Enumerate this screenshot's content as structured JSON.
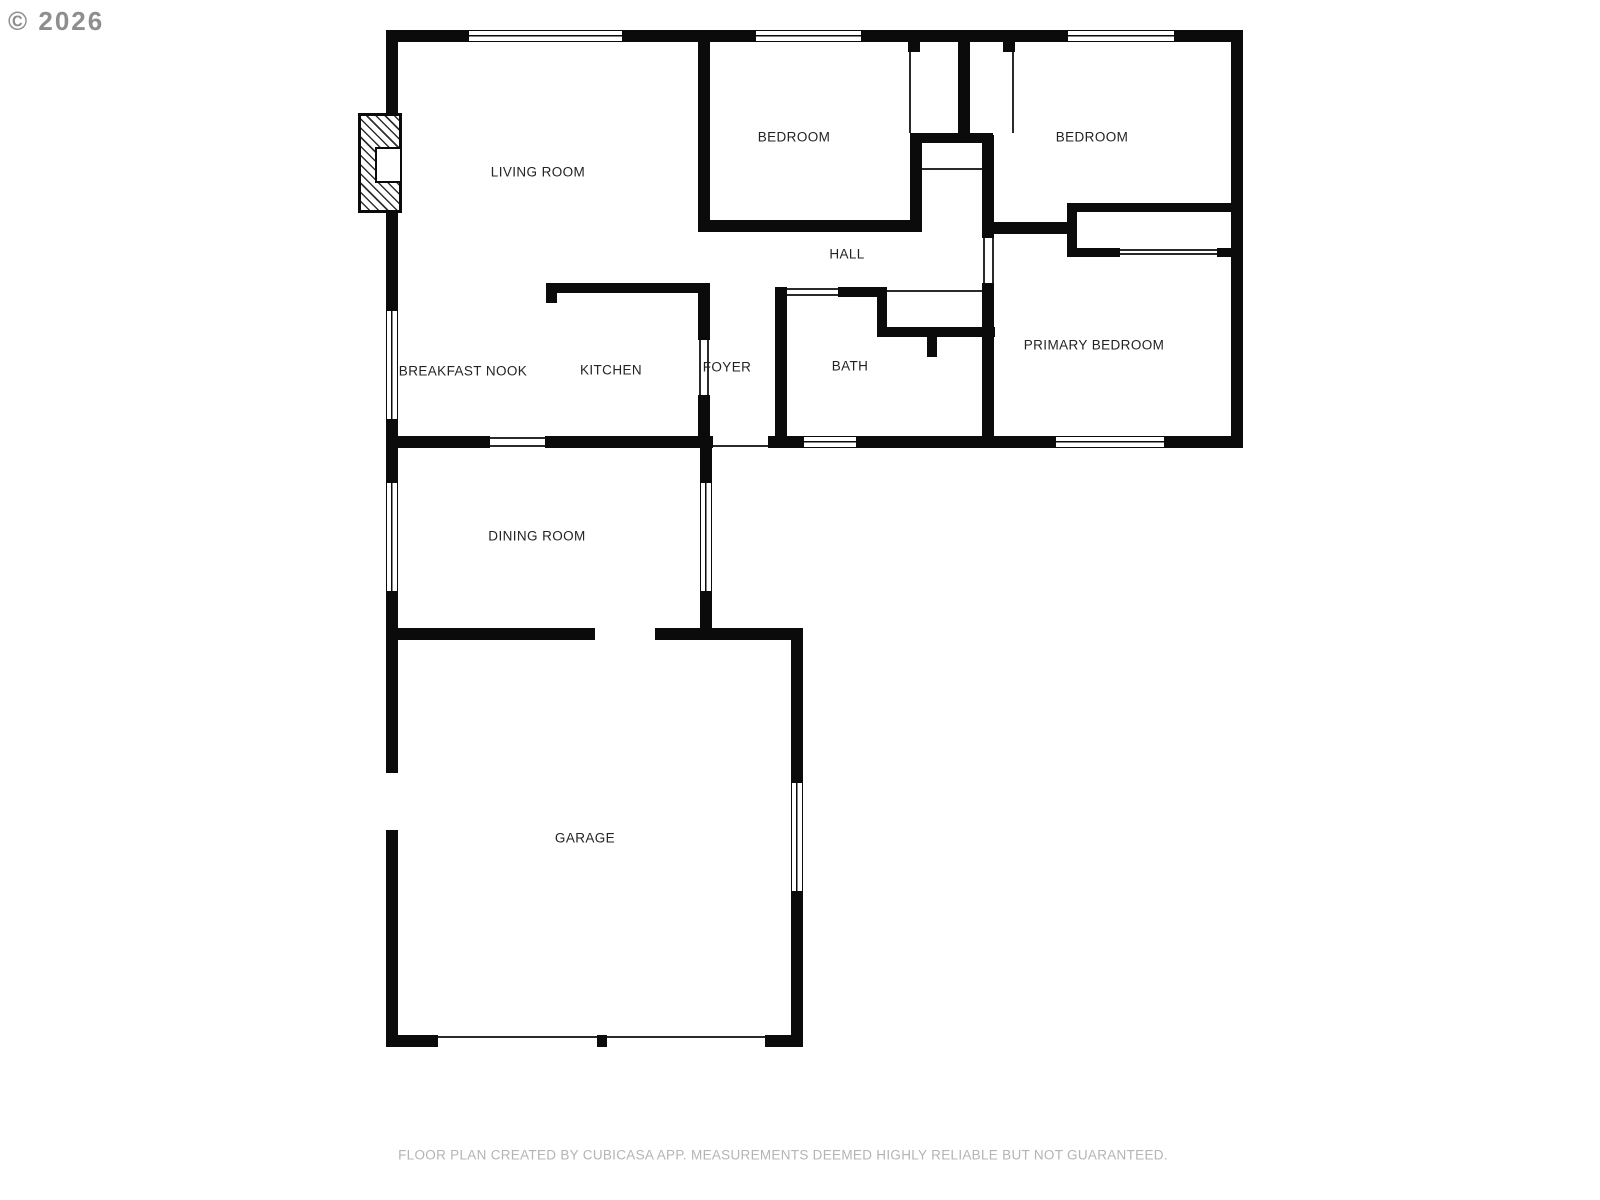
{
  "copyright": "© 2026",
  "footer": "FLOOR PLAN CREATED BY CUBICASA APP. MEASUREMENTS DEEMED HIGHLY RELIABLE BUT NOT GUARANTEED.",
  "colors": {
    "wall": "#0b0b0b",
    "label": "#232323",
    "footer_text": "#b4b4b4",
    "copyright": "#8e8e8e",
    "background": "#ffffff"
  },
  "rooms": [
    {
      "id": "living-room",
      "label": "LIVING ROOM",
      "x": 538,
      "y": 172
    },
    {
      "id": "bedroom-1",
      "label": "BEDROOM",
      "x": 794,
      "y": 137
    },
    {
      "id": "bedroom-2",
      "label": "BEDROOM",
      "x": 1092,
      "y": 137
    },
    {
      "id": "hall",
      "label": "HALL",
      "x": 847,
      "y": 254
    },
    {
      "id": "breakfast-nook",
      "label": "BREAKFAST NOOK",
      "x": 463,
      "y": 371
    },
    {
      "id": "kitchen",
      "label": "KITCHEN",
      "x": 611,
      "y": 370
    },
    {
      "id": "foyer",
      "label": "FOYER",
      "x": 727,
      "y": 367
    },
    {
      "id": "bath",
      "label": "BATH",
      "x": 850,
      "y": 366
    },
    {
      "id": "primary-bedroom",
      "label": "PRIMARY BEDROOM",
      "x": 1094,
      "y": 345
    },
    {
      "id": "dining-room",
      "label": "DINING ROOM",
      "x": 537,
      "y": 536
    },
    {
      "id": "garage",
      "label": "GARAGE",
      "x": 585,
      "y": 838
    }
  ],
  "plan": {
    "walls": [
      [
        386,
        30,
        82,
        12
      ],
      [
        623,
        30,
        132,
        12
      ],
      [
        862,
        30,
        205,
        12
      ],
      [
        1175,
        30,
        68,
        12
      ],
      [
        1231,
        30,
        12,
        418
      ],
      [
        386,
        436,
        104,
        12
      ],
      [
        545,
        436,
        168,
        12
      ],
      [
        768,
        436,
        35,
        12
      ],
      [
        857,
        436,
        198,
        12
      ],
      [
        1165,
        436,
        78,
        12
      ],
      [
        386,
        30,
        12,
        83
      ],
      [
        386,
        213,
        12,
        97
      ],
      [
        386,
        420,
        12,
        62
      ],
      [
        386,
        592,
        12,
        181
      ],
      [
        386,
        830,
        12,
        217
      ],
      [
        700,
        436,
        12,
        46
      ],
      [
        700,
        592,
        12,
        48
      ],
      [
        386,
        628,
        209,
        12
      ],
      [
        655,
        628,
        148,
        12
      ],
      [
        791,
        628,
        12,
        154
      ],
      [
        791,
        892,
        12,
        155
      ],
      [
        386,
        1035,
        52,
        12
      ],
      [
        597,
        1035,
        10,
        12
      ],
      [
        765,
        1035,
        38,
        12
      ],
      [
        698,
        30,
        12,
        192
      ],
      [
        698,
        220,
        220,
        12
      ],
      [
        910,
        133,
        12,
        99
      ],
      [
        908,
        42,
        12,
        10
      ],
      [
        958,
        42,
        12,
        100
      ],
      [
        1003,
        42,
        12,
        10
      ],
      [
        910,
        133,
        83,
        10
      ],
      [
        982,
        135,
        12,
        103
      ],
      [
        982,
        222,
        85,
        12
      ],
      [
        1067,
        203,
        176,
        9
      ],
      [
        1067,
        203,
        10,
        54
      ],
      [
        1067,
        248,
        53,
        9
      ],
      [
        1217,
        248,
        14,
        9
      ],
      [
        982,
        283,
        12,
        153
      ],
      [
        838,
        287,
        49,
        10
      ],
      [
        775,
        287,
        12,
        149
      ],
      [
        877,
        297,
        10,
        40
      ],
      [
        877,
        327,
        118,
        10
      ],
      [
        927,
        337,
        10,
        20
      ],
      [
        546,
        283,
        164,
        10
      ],
      [
        546,
        283,
        11,
        20
      ],
      [
        698,
        293,
        12,
        47
      ],
      [
        698,
        395,
        12,
        53
      ]
    ],
    "windows": [
      {
        "x": 468,
        "y": 30,
        "w": 155,
        "h": 12,
        "o": "h"
      },
      {
        "x": 755,
        "y": 30,
        "w": 107,
        "h": 12,
        "o": "h"
      },
      {
        "x": 1067,
        "y": 30,
        "w": 108,
        "h": 12,
        "o": "h"
      },
      {
        "x": 803,
        "y": 436,
        "w": 54,
        "h": 12,
        "o": "h"
      },
      {
        "x": 1055,
        "y": 436,
        "w": 110,
        "h": 12,
        "o": "h"
      },
      {
        "x": 386,
        "y": 310,
        "w": 12,
        "h": 110,
        "o": "v"
      },
      {
        "x": 386,
        "y": 482,
        "w": 12,
        "h": 110,
        "o": "v"
      },
      {
        "x": 700,
        "y": 482,
        "w": 12,
        "h": 110,
        "o": "v"
      },
      {
        "x": 791,
        "y": 782,
        "w": 12,
        "h": 110,
        "o": "v"
      }
    ],
    "door_lines": [
      [
        909,
        52,
        2,
        81
      ],
      [
        1012,
        52,
        2,
        81
      ],
      [
        922,
        168,
        60,
        2
      ],
      [
        1120,
        249,
        97,
        2
      ],
      [
        1120,
        253,
        97,
        2
      ],
      [
        787,
        288,
        51,
        2
      ],
      [
        787,
        294,
        51,
        2
      ],
      [
        887,
        290,
        95,
        2
      ],
      [
        983,
        238,
        2,
        45
      ],
      [
        992,
        238,
        2,
        45
      ],
      [
        699,
        340,
        2,
        55
      ],
      [
        707,
        340,
        2,
        55
      ],
      [
        490,
        437,
        55,
        2
      ],
      [
        490,
        445,
        55,
        2
      ],
      [
        713,
        445,
        55,
        2
      ],
      [
        438,
        1036,
        159,
        2
      ],
      [
        607,
        1036,
        158,
        2
      ]
    ],
    "fireplace": {
      "x": 358,
      "y": 113,
      "w": 44,
      "h": 100,
      "firebox": {
        "x": 375,
        "y": 147,
        "w": 27,
        "h": 36
      }
    }
  }
}
